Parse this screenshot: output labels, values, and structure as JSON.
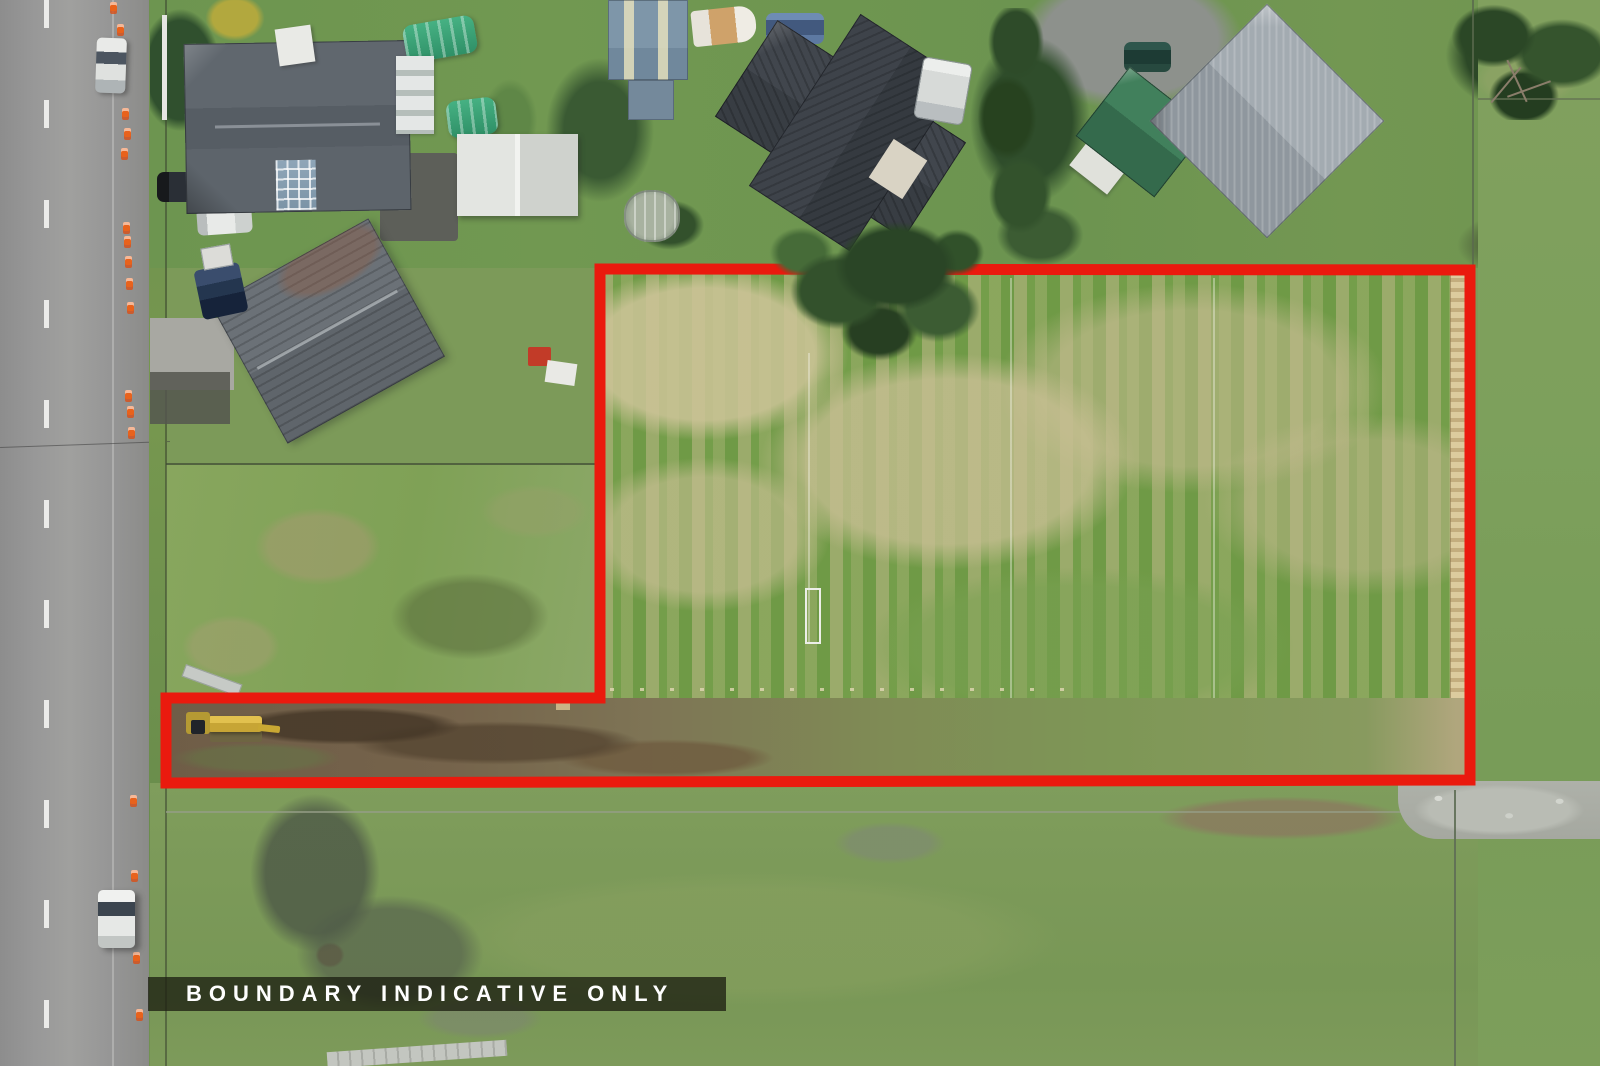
{
  "overlay": {
    "label": "BOUNDARY INDICATIVE ONLY"
  },
  "boundary": {
    "color": "#ea1a0e",
    "stroke_width": 11,
    "points": "600,269 1470,270 1470,780 166,783 166,698 600,698"
  },
  "palette": {
    "boundary_red": "#ea1a0e",
    "label_bg": "#1d2012",
    "label_text": "#fefefe",
    "road_asphalt": "#949494",
    "road_marking": "#f2f2f0",
    "kerb": "#bfc1bb",
    "lawn_green": "#6f9751",
    "field_green": "#7aa24e",
    "field_tan": "#c6bd95",
    "paddock_rough": "#85a35c",
    "pasture_south": "#7c9a59",
    "dirt_brown": "#6f5d47",
    "timber_fence": "#d6c08e",
    "tree_dark": "#2c4827",
    "greenhouse_teal": "#3aa57a",
    "cone_orange": "#e8621c",
    "excavator_yellow": "#d7b440",
    "gravel_gray": "#b9bcb4"
  },
  "road": {
    "cones": [
      [
        110,
        2
      ],
      [
        117,
        24
      ],
      [
        122,
        108
      ],
      [
        124,
        128
      ],
      [
        121,
        148
      ],
      [
        123,
        222
      ],
      [
        124,
        236
      ],
      [
        125,
        256
      ],
      [
        126,
        278
      ],
      [
        127,
        302
      ],
      [
        125,
        390
      ],
      [
        127,
        406
      ],
      [
        128,
        427
      ],
      [
        130,
        795
      ],
      [
        131,
        870
      ],
      [
        133,
        952
      ],
      [
        136,
        1009
      ]
    ]
  }
}
